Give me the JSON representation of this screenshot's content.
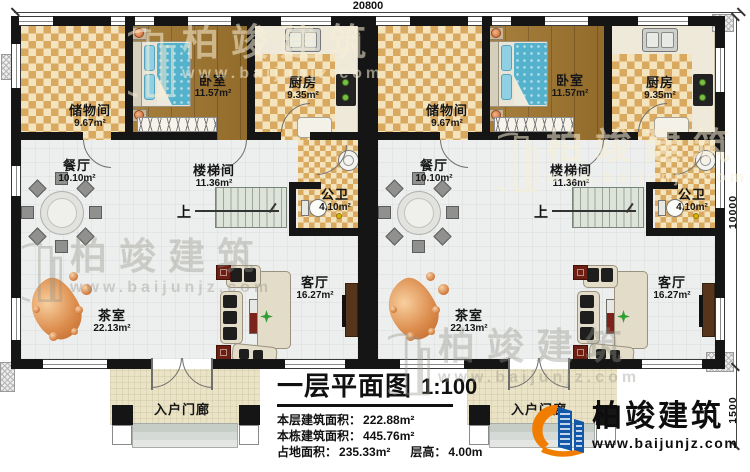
{
  "plan": {
    "dimensions": {
      "top_width": "20800",
      "right_height": "10000",
      "right_porch": "1500"
    },
    "rooms": {
      "storage": {
        "name": "储物间",
        "area": "9.67m²"
      },
      "bedroom": {
        "name": "卧室",
        "area": "11.57m²"
      },
      "kitchen": {
        "name": "厨房",
        "area": "9.35m²"
      },
      "dining": {
        "name": "餐厅",
        "area": "10.10m²"
      },
      "stairwell": {
        "name": "楼梯间",
        "area": "11.36m²"
      },
      "bathroom": {
        "name": "公卫",
        "area": "4.10m²"
      },
      "tearoom": {
        "name": "茶室",
        "area": "22.13m²"
      },
      "living": {
        "name": "客厅",
        "area": "16.27m²"
      },
      "porch": {
        "name": "入户门廊"
      }
    },
    "stairs": {
      "up_label": "上"
    }
  },
  "title_block": {
    "title": "一层平面图",
    "scale": "1:100",
    "stats": [
      {
        "label": "本层建筑面积：",
        "value": "222.88m²"
      },
      {
        "label": "本栋建筑面积：",
        "value": "445.76m²"
      },
      {
        "label": "占地面积：",
        "value": "235.33m²"
      },
      {
        "label": "层高：",
        "value": "4.00m"
      }
    ]
  },
  "branding": {
    "company": "柏竣建筑",
    "website": "www.baijunjz.com"
  },
  "watermark": {
    "company": "柏竣建筑",
    "website": "www.baijunjz.com"
  },
  "colors": {
    "wall": "#151515",
    "checker_tan": "#d9a95f",
    "wood": "#a1762e",
    "logo_blue": "#1358a8",
    "logo_orange": "#f07d00",
    "rug_red": "#7c241b"
  }
}
